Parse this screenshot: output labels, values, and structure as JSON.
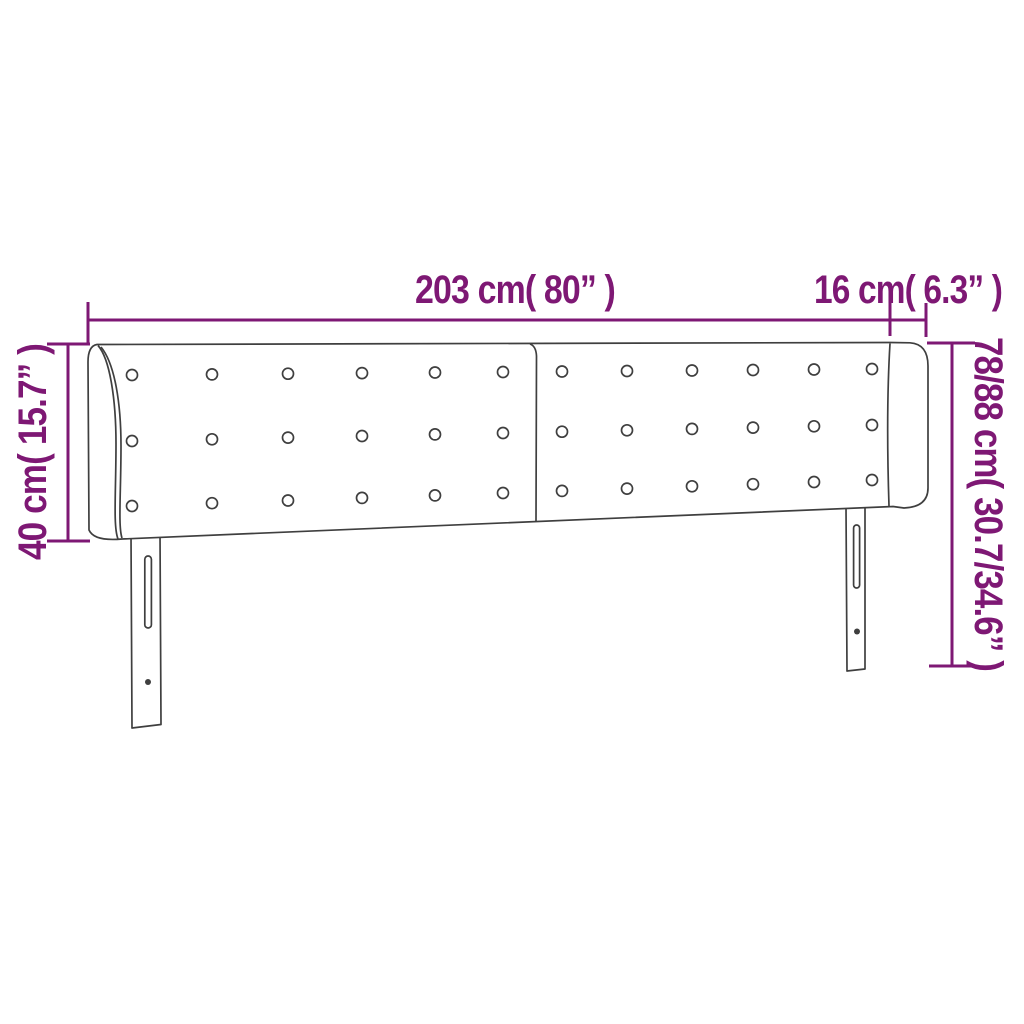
{
  "diagram": {
    "labels": {
      "total_width": "203 cm( 80” )",
      "wing_depth": "16 cm( 6.3” )",
      "panel_height": "40 cm( 15.7” )",
      "total_height": "78/88 cm( 30.7/34.6” )"
    },
    "measurements": [
      {
        "side": "top",
        "cm": "203",
        "inch": "80"
      },
      {
        "side": "top-right",
        "cm": "16",
        "inch": "6.3"
      },
      {
        "side": "left",
        "cm": "40",
        "inch": "15.7"
      },
      {
        "side": "right",
        "cm": "78/88",
        "inch": "30.7/34.6"
      }
    ],
    "colors": {
      "dimension": "#7E1874",
      "outline": "#3F3F3F",
      "background": "#FFFFFF"
    }
  }
}
